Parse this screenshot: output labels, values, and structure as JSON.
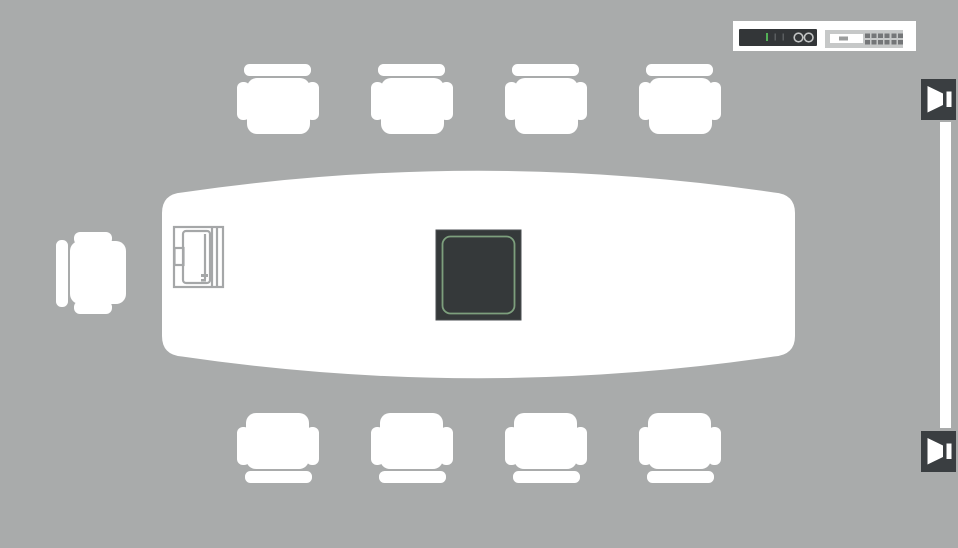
{
  "scene": {
    "description": "Top-down conference room AV floor plan",
    "chairs": {
      "top_row": 4,
      "bottom_row": 4,
      "left_side": 1,
      "total": 9
    }
  },
  "colors": {
    "background": "#a9abab",
    "furniture": "#ffffff",
    "equipment_dark": "#35393a",
    "panel_green": "#7d9f7d",
    "panel_edge": "#4a4e50",
    "line_drawing": "#a5a7a8",
    "screen_white": "#ffffff",
    "speaker_tile": "#3a3e41",
    "speaker_glyph": "#ffffff",
    "rack_panel_bg": "#ffffff",
    "amp_body": "#333638",
    "amp_led_green": "#53b156",
    "amp_tick": "#5a5d5f",
    "amp_knob_ring": "#c2c4c4",
    "switcher_body": "#c6c8c8",
    "switcher_slot": "#ffffff",
    "switcher_dash": "#9b9d9d",
    "port_dark": "#747678"
  },
  "devices": {
    "table_touch_panel": {
      "icon": "touch-panel-icon",
      "state": "highlighted-green"
    },
    "table_enclosure": {
      "icon": "cable-enclosure-icon"
    },
    "display_screen": {
      "icon": "screen-strip"
    },
    "speaker_top": {
      "icon": "speaker-icon",
      "position": "top-right"
    },
    "speaker_bottom": {
      "icon": "speaker-icon",
      "position": "bottom-right"
    },
    "rack_amplifier": {
      "icon": "amplifier-front-panel",
      "knobs": 2,
      "led": "green"
    },
    "rack_switcher": {
      "icon": "switcher-front-panel",
      "port_groups": 2
    }
  }
}
